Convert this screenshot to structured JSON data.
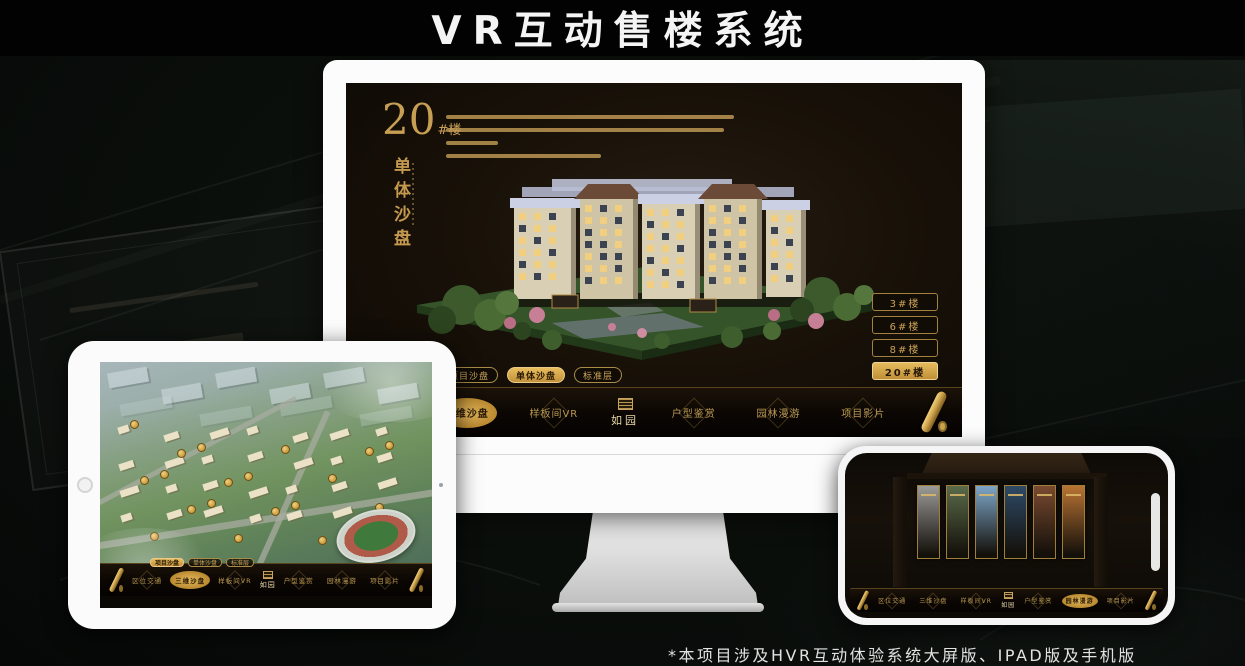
{
  "page": {
    "title": "VR互动售楼系统",
    "footnote": "*本项目涉及HVR互动体验系统大屏版、IPAD版及手机版"
  },
  "nav": {
    "items": [
      "区位交通",
      "三维沙盘",
      "样板间VR",
      "户型鉴赏",
      "园林漫游",
      "项目影片"
    ],
    "logo": "如园"
  },
  "desktop": {
    "heading_number": "20",
    "heading_suffix": "#楼",
    "heading_vertical": "单体沙盘",
    "view_tabs": [
      "项目沙盘",
      "单体沙盘",
      "标准层"
    ],
    "active_view_tab": "单体沙盘",
    "building_buttons": [
      "3#楼",
      "6#楼",
      "8#楼",
      "20#楼"
    ],
    "active_building": "20#楼",
    "active_nav": "三维沙盘"
  },
  "tablet": {
    "view_tabs": [
      "项目沙盘",
      "单体沙盘",
      "标准层"
    ],
    "active_view_tab": "项目沙盘",
    "active_nav": "三维沙盘"
  },
  "phone": {
    "active_nav": "园林漫游"
  },
  "colors": {
    "gold": "#c9a45c",
    "gold_bright": "#ddaa4f",
    "nav_bg": "#0d0a06",
    "screen_bg": "#171008",
    "lit_window": "#f2cf7e",
    "dark_window": "#3c4350"
  }
}
